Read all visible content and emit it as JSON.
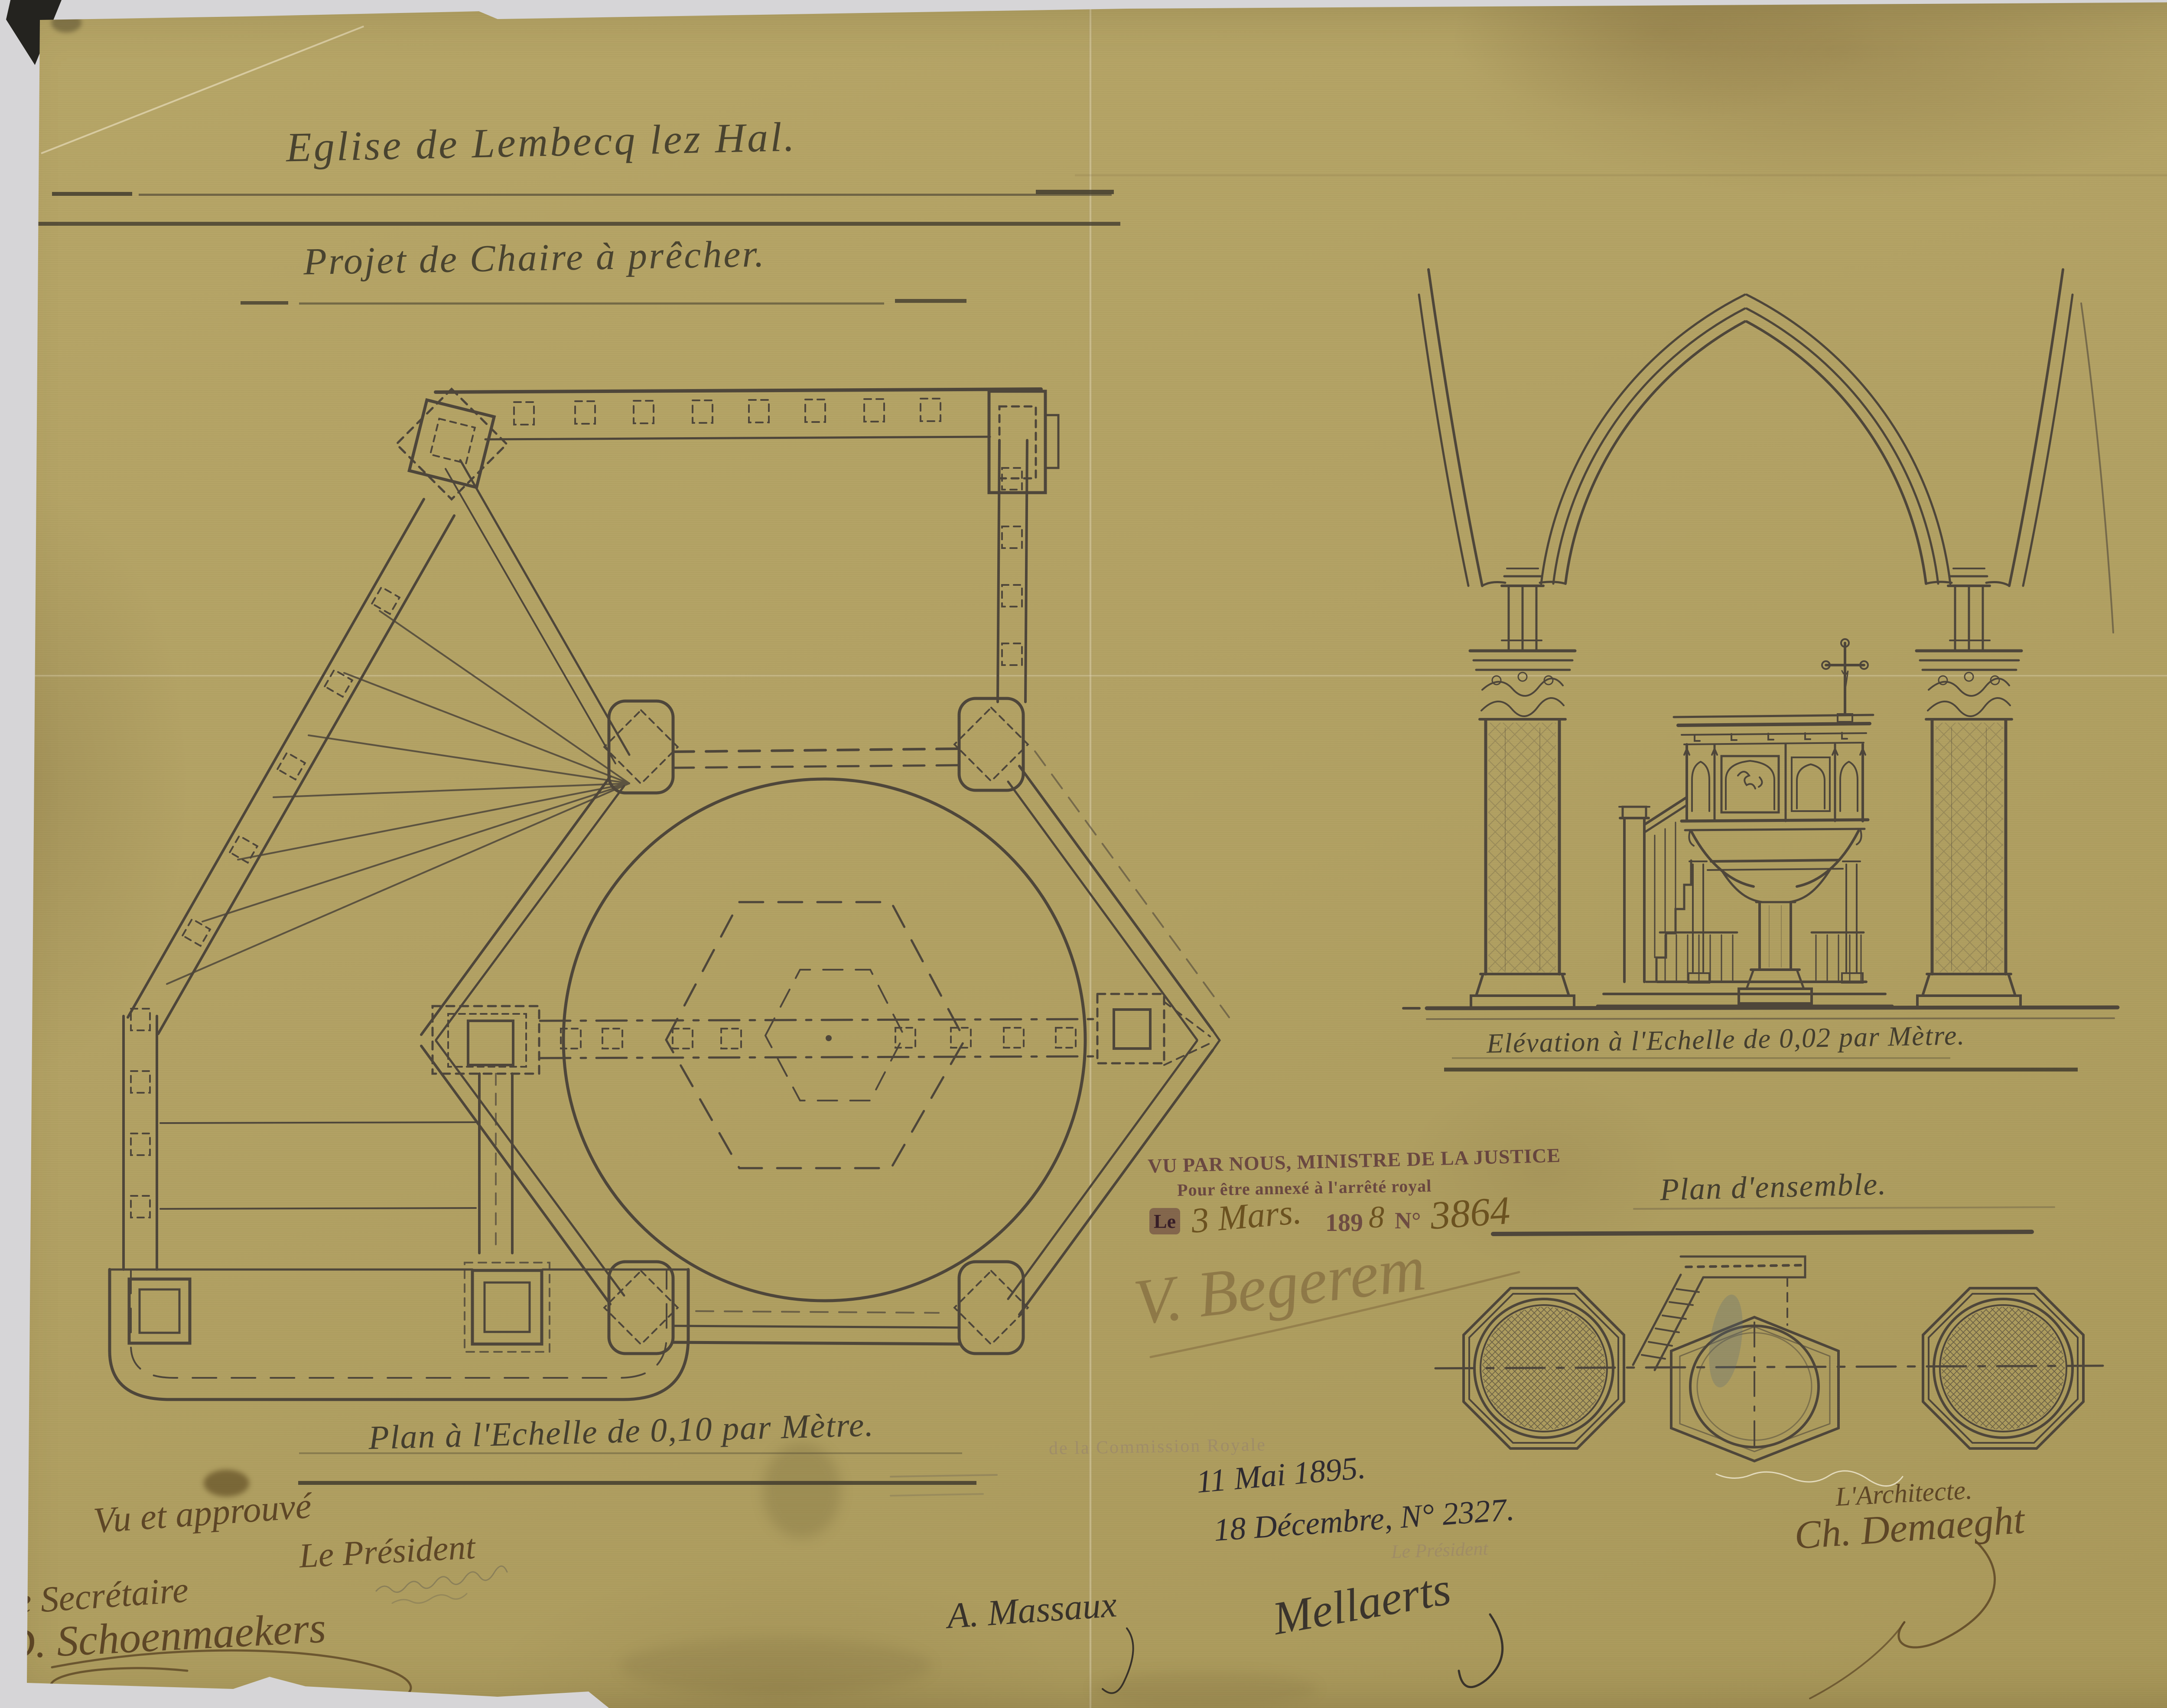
{
  "page": {
    "title_line1": "Eglise de Lembecq lez Hal.",
    "title_line2": "Projet de Chaire à prêcher.",
    "captions": {
      "plan": "Plan à l'Echelle de 0,10 par Mètre.",
      "elevation": "Elévation à l'Echelle de 0,02 par Mètre.",
      "ensemble": "Plan d'ensemble."
    },
    "stamp": {
      "line1": "VU PAR NOUS, MINISTRE DE LA JUSTICE",
      "line2": "Pour être annexé à l'arrêté royal",
      "le": "Le",
      "date": "3 Mars.",
      "year_printed": "189",
      "year_digit": "8",
      "no_label": "N°",
      "no_value": "3864"
    },
    "annotations": {
      "date1": "11 Mai 1895.",
      "date2": "18 Décembre, N° 2327.",
      "vu_approuve": "Vu et approuvé",
      "president": "Le Président",
      "secretaire": "Le Secrétaire",
      "secretaire_sig": "D. Schoenmaekers",
      "minister_sig": "V. Begerem",
      "massaux_sig": "A. Massaux",
      "mellaerts_sig": "Mellaerts",
      "architecte": "L'Architecte.",
      "architecte_sig": "Ch. Demaeght",
      "ghost_stamp": "de la Commission Royale",
      "ghost_president": "Le Président"
    },
    "colors": {
      "paper": "#b2a163",
      "ink": "#4e463a",
      "brown_ink": "#5d4626",
      "purple_stamp": "#8a5b9c",
      "dark_ink": "#33302c"
    }
  }
}
